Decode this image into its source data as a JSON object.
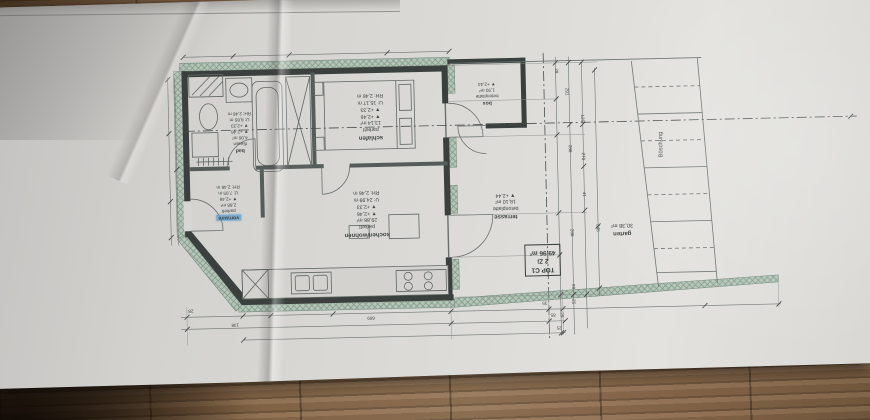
{
  "colors": {
    "paper": "#d9d8d4",
    "wall": "#3b403e",
    "insulation_hatch": "#b5c5b8",
    "drawing_lines": "#616765",
    "marker_highlight": "#5c9ccd",
    "wood_light": "#97785a",
    "wood_dark": "#45321f"
  },
  "rooms": {
    "schlafen": {
      "name": "schlafen",
      "floor": "parkett",
      "area": "13,14 m²",
      "level_a": "▼ +2,46",
      "level_b": "▼ +2,33",
      "perimeter": "U: 15,17 m",
      "clear_height": "RH: 2,46 m"
    },
    "kochen_wohnen": {
      "name": "kochen/wohnen",
      "floor": "parkett",
      "area": "29,88 m²",
      "level_a": "▼ +2,46",
      "level_b": "▼ +2,33",
      "perimeter": "U: 24,99 m",
      "clear_height": "RH: 2,46 m"
    },
    "bad": {
      "name": "bad",
      "floor": "fliesen",
      "area": "4,06 m²",
      "level_a": "▼ +2,46",
      "level_b": "▼ +2,33",
      "perimeter": "U: 8,85 m",
      "clear_height": "RH: 2,46 m"
    },
    "vorraum": {
      "name": "vorraum",
      "floor": "parkett",
      "area": "2,88 m²",
      "level_a": "▼ +2,46",
      "perimeter": "U: 7,05 m",
      "clear_height": "RH: 2,46 m"
    },
    "box": {
      "name": "box",
      "floor": "betonplatte",
      "area": "1,93 m²",
      "level_a": "▼ +2,44"
    },
    "terrasse": {
      "name": "terrasse",
      "floor": "betonplatte",
      "area": "18,10 m²",
      "level_a": "▼ +2,44"
    },
    "garten": {
      "name": "garten",
      "area": "30,38 m²"
    }
  },
  "unit": {
    "top": "TOP C1",
    "rooms_count": "2 Zi",
    "total_area": "49,96 m²"
  },
  "site": {
    "slope_label": "Böschung"
  },
  "dims": {
    "right": [
      "291",
      "29",
      "125",
      "288",
      "270",
      "41",
      "288",
      "345",
      "99",
      "25",
      "29"
    ],
    "bottom": [
      "669",
      "138",
      "85",
      "35",
      "28",
      "25"
    ]
  }
}
